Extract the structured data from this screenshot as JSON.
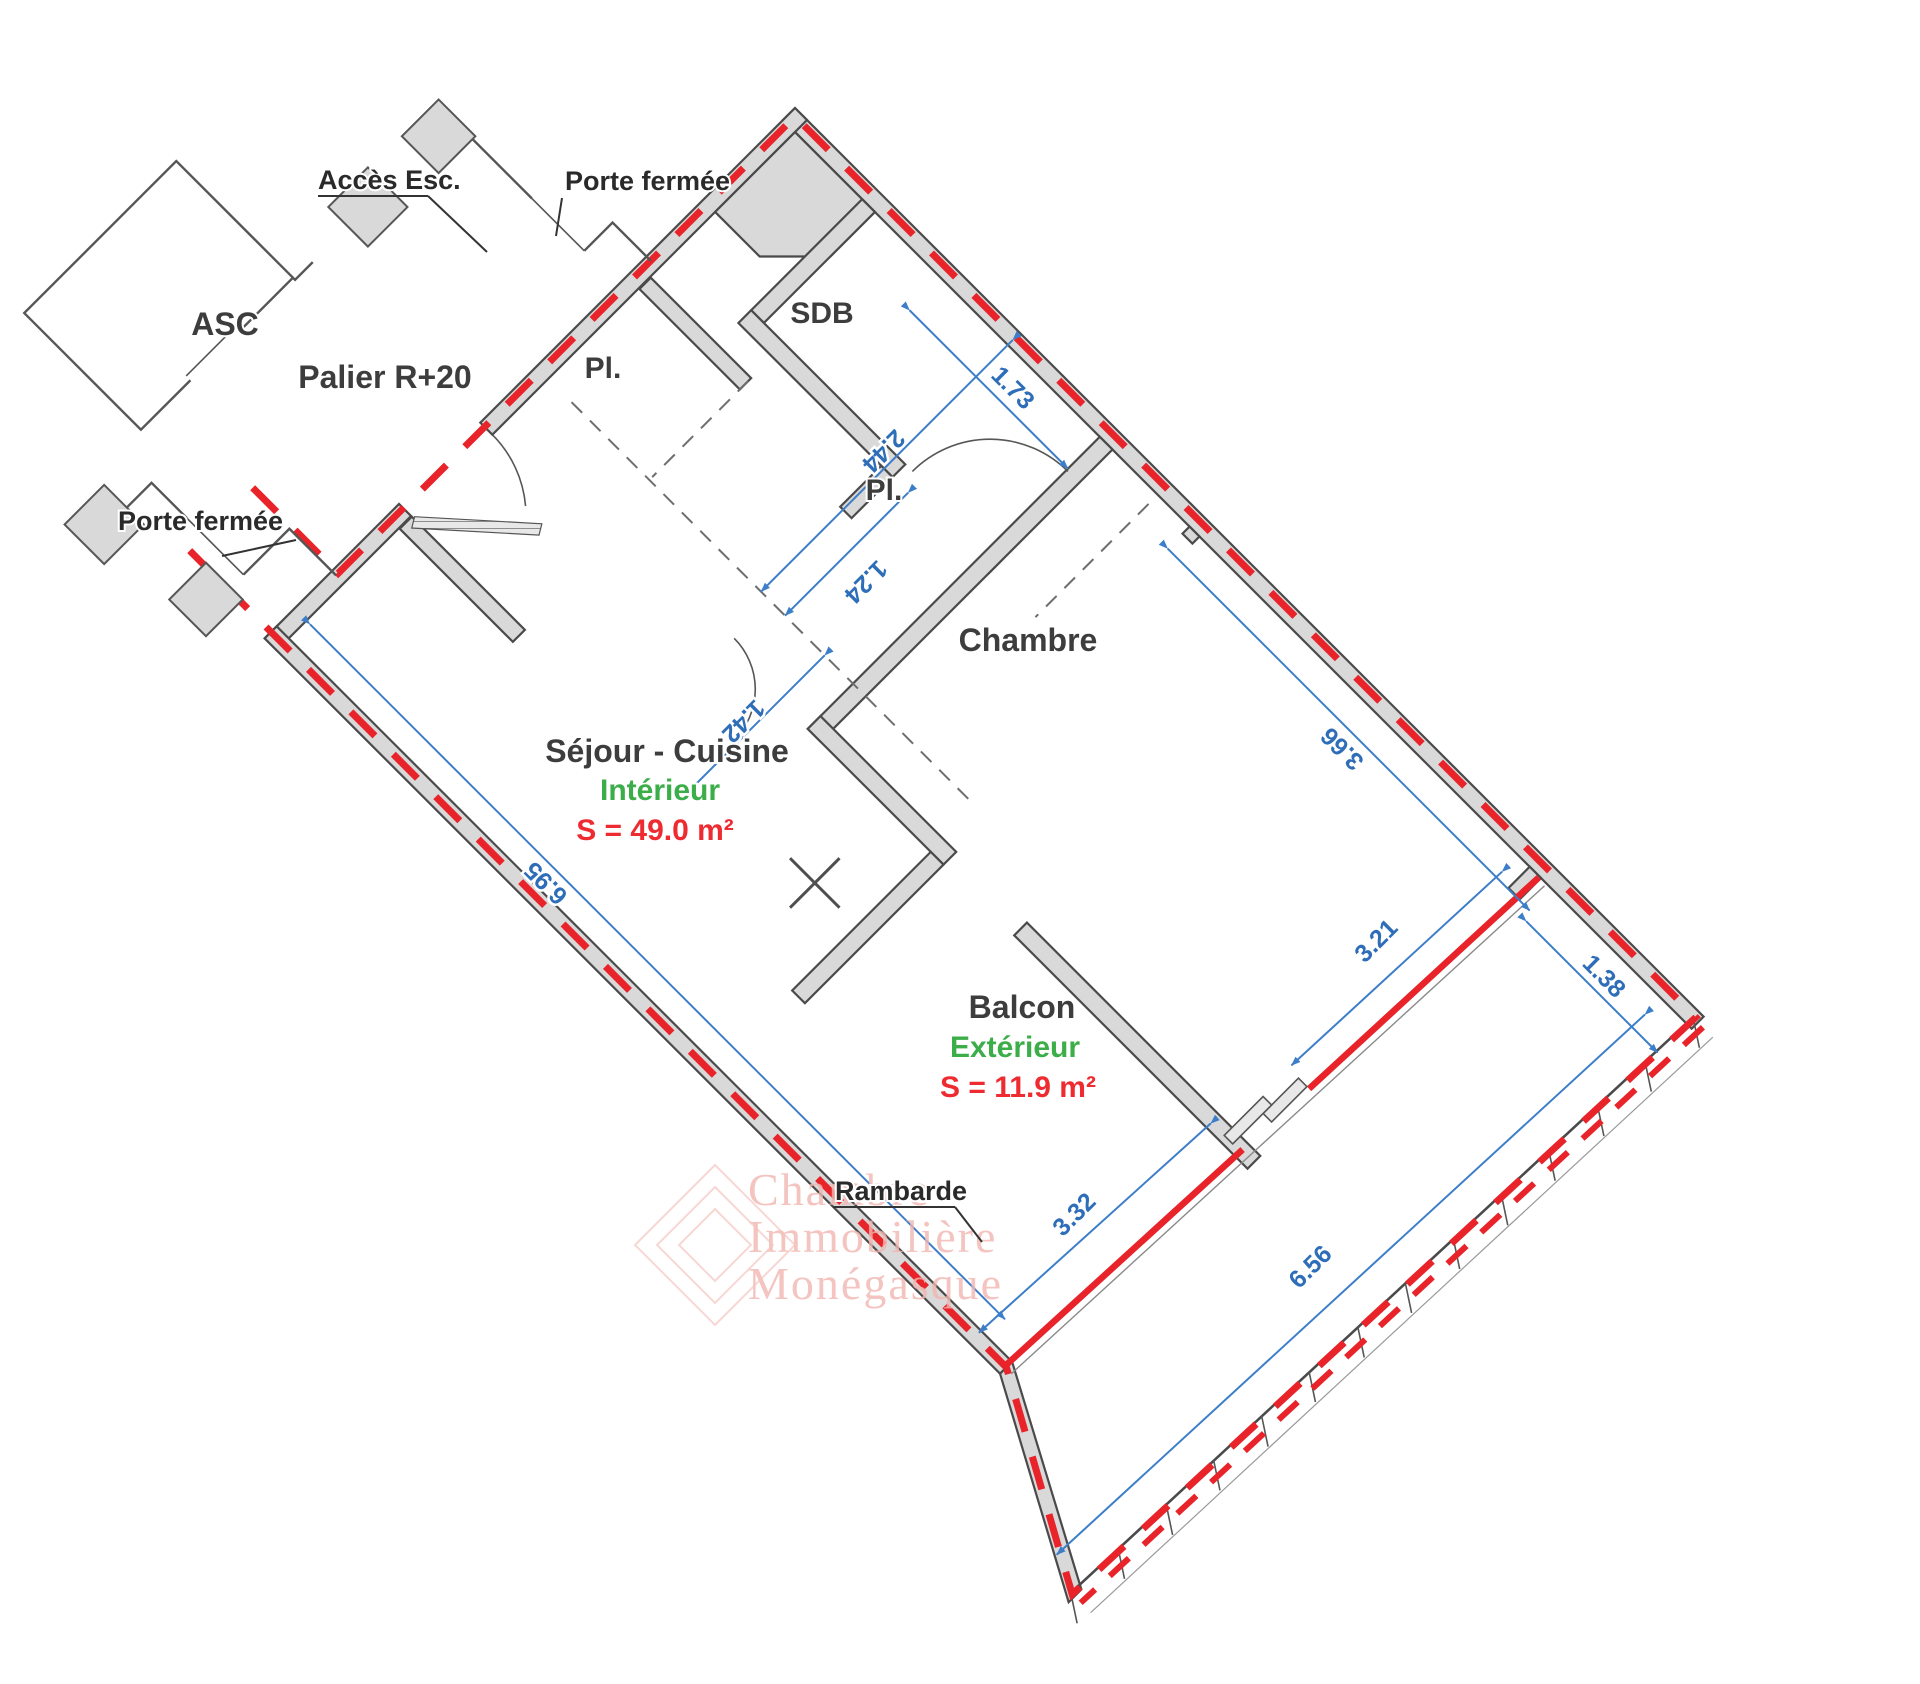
{
  "title": "Plan d'appartement Palier R+20",
  "colors": {
    "wall_fill": "#d9d9d9",
    "wall_line": "#4a4a4a",
    "boundary_red": "#e82329",
    "dim_blue": "#3d7ec9",
    "dim_text_blue": "#2e6db8",
    "label_dark": "#3d3d3d",
    "zone_green": "#3cae49",
    "area_red": "#ee2b30",
    "watermark_pink": "#f1b6b1"
  },
  "palier": {
    "asc": "ASC",
    "palier": "Palier R+20",
    "acces_esc": "Accès Esc.",
    "porte_fermee_top": "Porte fermée",
    "porte_fermee_left": "Porte fermée"
  },
  "rooms": {
    "sdb": "SDB",
    "pl_entree": "Pl.",
    "pl_chambre": "Pl.",
    "chambre": "Chambre",
    "sejour": "Séjour - Cuisine",
    "sejour_zone": "Intérieur",
    "sejour_area": "S = 49.0 m²",
    "balcon": "Balcon",
    "balcon_zone": "Extérieur",
    "balcon_area": "S = 11.9 m²",
    "rambarde": "Rambarde"
  },
  "dimensions": {
    "d244": "2.44",
    "d124": "1.24",
    "d142": "1.42",
    "d173": "1.73",
    "d366": "3.66",
    "d138": "1.38",
    "d321": "3.21",
    "d332": "3.32",
    "d656": "6.56",
    "d695": "6.95"
  },
  "watermark": {
    "line1": "Chambre",
    "line2": "Immobilière",
    "line3": "Monégasque"
  }
}
